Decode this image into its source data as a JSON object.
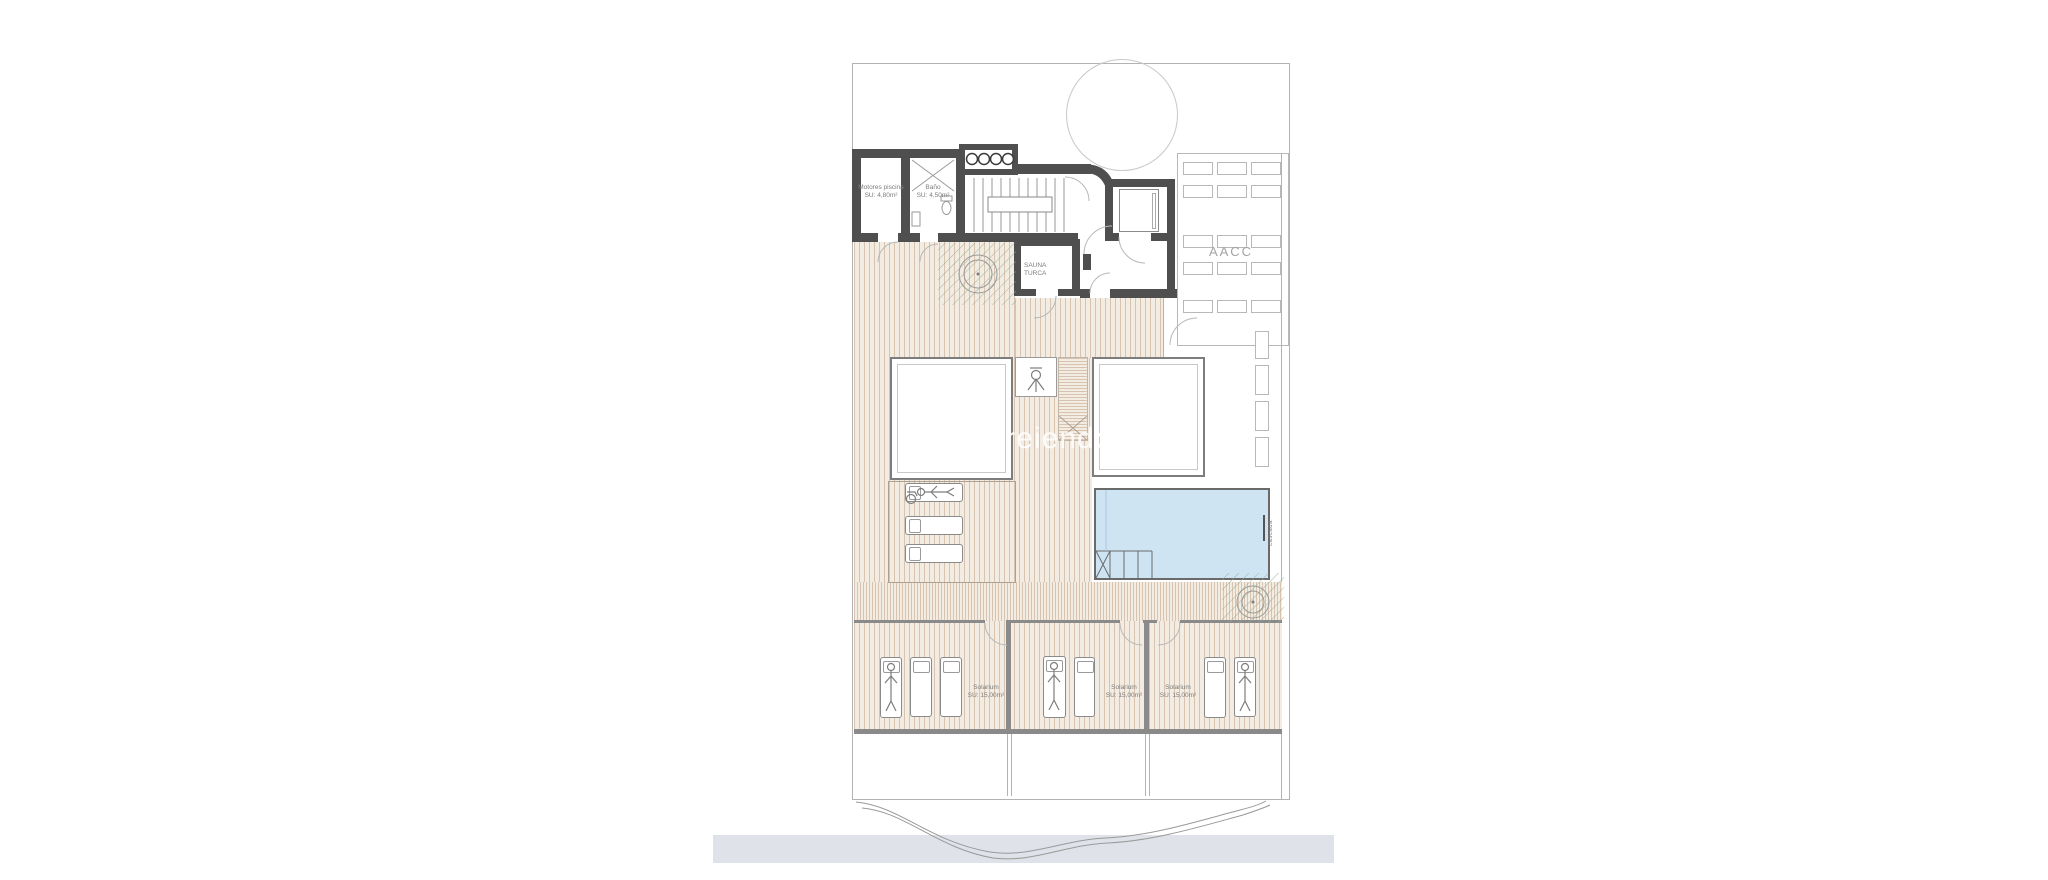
{
  "watermark": "areiendo",
  "rooms": {
    "motores_piscina": {
      "name": "Motores piscina",
      "area": "SU: 4,80m²"
    },
    "bano": {
      "name": "Baño",
      "area": "SU: 4,50m²"
    },
    "sauna_turca": {
      "line1": "SAUNA",
      "line2": "TURCA"
    },
    "aacc": {
      "label": "AACC"
    },
    "pool": {
      "feature_label": "cascada"
    }
  },
  "solariums": [
    {
      "name": "Solarium",
      "area": "SU: 15,00m²"
    },
    {
      "name": "Solarium",
      "area": "SU: 15,00m²"
    },
    {
      "name": "Solarium",
      "area": "SU: 15,00m²"
    }
  ],
  "colors": {
    "wall": "#4f4f4f",
    "inner_wall": "#8a8a8a",
    "boundary": "#b3b3b3",
    "deck_bg": "#f3ece2",
    "deck_stripe": "#d8c3b0",
    "pool": "#cfe4f3",
    "plant": "#8fae8c",
    "footer_bar": "#dfe2e9"
  }
}
